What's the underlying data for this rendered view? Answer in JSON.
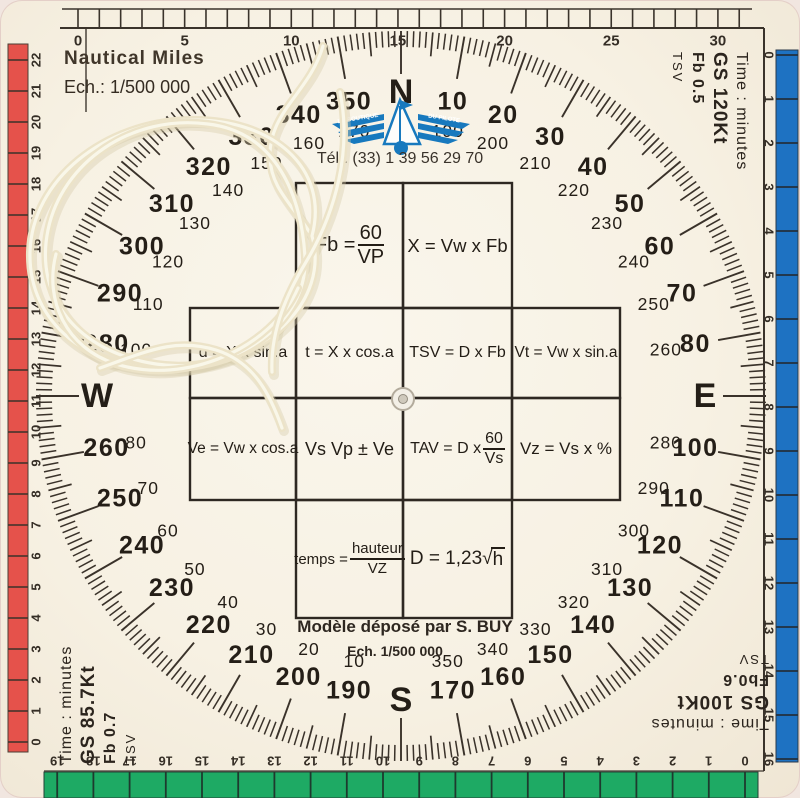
{
  "header": {
    "title": "Nautical Miles",
    "scale": "Ech.: 1/500 000",
    "phone": "Tél.: (33) 1 39 56 29 70"
  },
  "logo": {
    "name": "La Boutique du Pilote",
    "left_wing": "LA BOUTIQUE",
    "right_wing": "DU PILOTE"
  },
  "footer": {
    "deposit": "Modèle déposé par S. BUY",
    "scale": "Ech. 1/500 000"
  },
  "corner_blocks": {
    "top_right": [
      "Time : minutes",
      "GS 120Kt",
      "Fb 0.5",
      "TSV"
    ],
    "bottom_left": [
      "Time : minutes",
      "GS 85.7Kt",
      "Fb 0.7",
      "TSV"
    ],
    "bottom_right": [
      "Time : minutes",
      "GS 100Kt",
      "Fb0.6",
      "TSV"
    ]
  },
  "formulas": {
    "fb": {
      "pre": "Fb = ",
      "num": "60",
      "den": "VP"
    },
    "x": {
      "text": "X = Vw x Fb"
    },
    "drift": {
      "text": "d = X x sin.a"
    },
    "t": {
      "text": "t = X x cos.a"
    },
    "tsv": {
      "text": "TSV = D x Fb"
    },
    "vt": {
      "text": "Vt = Vw x sin.a"
    },
    "ve": {
      "text": "Ve = Vw x cos.a"
    },
    "vs": {
      "text": "Vs Vp ± Ve"
    },
    "tav": {
      "pre": "TAV = D x ",
      "num": "60",
      "den": "Vs"
    },
    "vz": {
      "text": "Vz = Vs x %"
    },
    "temps": {
      "pre": "temps = ",
      "num": "hauteur",
      "den": "VZ"
    },
    "dist": {
      "pre": "D = 1,23 ",
      "rad": "√",
      "arg": "h"
    }
  },
  "compass": {
    "cardinals": [
      {
        "a": 0,
        "label": "N"
      },
      {
        "a": 90,
        "label": "E"
      },
      {
        "a": 180,
        "label": "S"
      },
      {
        "a": 270,
        "label": "W"
      }
    ],
    "labels": [
      {
        "a": 10,
        "outer": "10",
        "inner": "190"
      },
      {
        "a": 20,
        "outer": "20",
        "inner": "200"
      },
      {
        "a": 30,
        "outer": "30",
        "inner": "210"
      },
      {
        "a": 40,
        "outer": "40",
        "inner": "220"
      },
      {
        "a": 50,
        "outer": "50",
        "inner": "230"
      },
      {
        "a": 60,
        "outer": "60",
        "inner": "240"
      },
      {
        "a": 70,
        "outer": "70",
        "inner": "250"
      },
      {
        "a": 80,
        "outer": "80",
        "inner": "260"
      },
      {
        "a": 100,
        "outer": "100",
        "inner": "280"
      },
      {
        "a": 110,
        "outer": "110",
        "inner": "290"
      },
      {
        "a": 120,
        "outer": "120",
        "inner": "300"
      },
      {
        "a": 130,
        "outer": "130",
        "inner": "310"
      },
      {
        "a": 140,
        "outer": "140",
        "inner": "320"
      },
      {
        "a": 150,
        "outer": "150",
        "inner": "330"
      },
      {
        "a": 160,
        "outer": "160",
        "inner": "340"
      },
      {
        "a": 170,
        "outer": "170",
        "inner": "350"
      },
      {
        "a": 190,
        "outer": "190",
        "inner": "10"
      },
      {
        "a": 200,
        "outer": "200",
        "inner": "20"
      },
      {
        "a": 210,
        "outer": "210",
        "inner": "30"
      },
      {
        "a": 220,
        "outer": "220",
        "inner": "40"
      },
      {
        "a": 230,
        "outer": "230",
        "inner": "50"
      },
      {
        "a": 240,
        "outer": "240",
        "inner": "60"
      },
      {
        "a": 250,
        "outer": "250",
        "inner": "70"
      },
      {
        "a": 260,
        "outer": "260",
        "inner": "80"
      },
      {
        "a": 280,
        "outer": "280",
        "inner": "100"
      },
      {
        "a": 290,
        "outer": "290",
        "inner": "110"
      },
      {
        "a": 300,
        "outer": "300",
        "inner": "120"
      },
      {
        "a": 310,
        "outer": "310",
        "inner": "130"
      },
      {
        "a": 320,
        "outer": "320",
        "inner": "140"
      },
      {
        "a": 330,
        "outer": "330",
        "inner": "150"
      },
      {
        "a": 340,
        "outer": "340",
        "inner": "160"
      },
      {
        "a": 350,
        "outer": "350",
        "inner": "170"
      }
    ],
    "tick_steps": {
      "minor_deg": 1,
      "medium_deg": 5,
      "major_deg": 10
    }
  },
  "rulers": {
    "top": {
      "numbers": [
        "0",
        "5",
        "10",
        "15",
        "20",
        "25",
        "30"
      ]
    },
    "right": {
      "numbers": [
        "0",
        "1",
        "2",
        "3",
        "4",
        "5",
        "6",
        "7",
        "8",
        "9",
        "10",
        "11",
        "12",
        "13",
        "14",
        "15",
        "16"
      ]
    },
    "bottom": {
      "numbers": [
        "0",
        "1",
        "2",
        "3",
        "4",
        "5",
        "6",
        "7",
        "8",
        "9",
        "10",
        "11",
        "12",
        "13",
        "14",
        "15",
        "16",
        "17",
        "18",
        "19"
      ]
    },
    "left": {
      "numbers": [
        "22",
        "21",
        "20",
        "19",
        "18",
        "17",
        "16",
        "15",
        "14",
        "13",
        "12",
        "11",
        "10",
        "9",
        "8",
        "7",
        "6",
        "5",
        "4",
        "3",
        "2",
        "1",
        "0"
      ]
    }
  },
  "colors": {
    "red_band": "#e5524b",
    "blue_band": "#1e72c2",
    "green_band": "#1eaa64",
    "ink": "#352e26",
    "rose_ink": "#241e17",
    "logo_blue": "#1779be",
    "string": "#ece3c8"
  }
}
